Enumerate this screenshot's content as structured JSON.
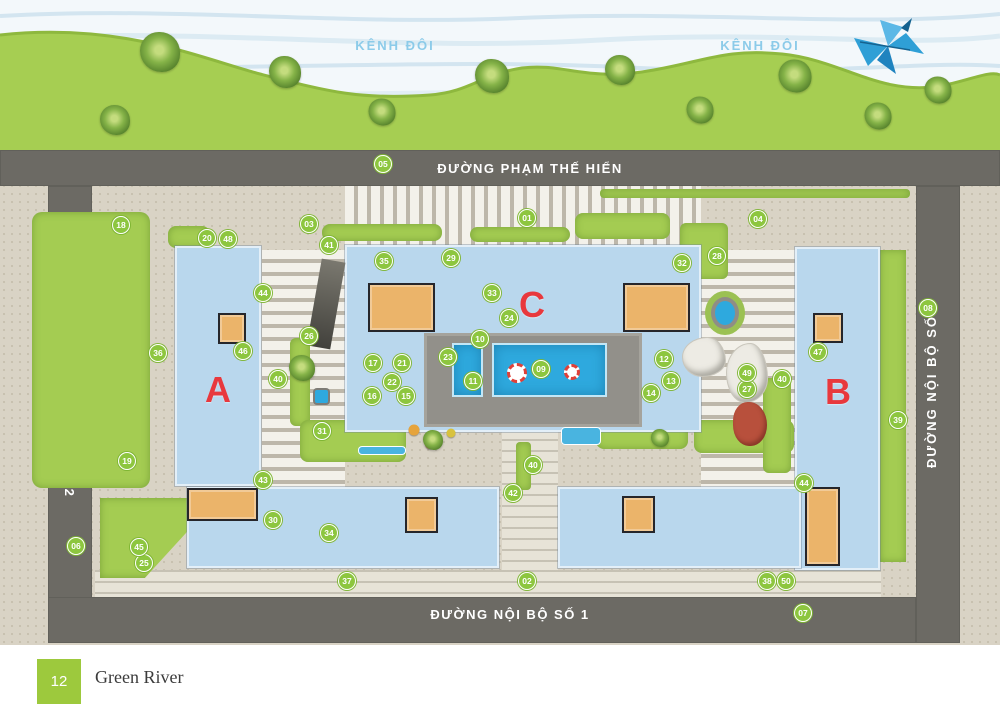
{
  "river": {
    "labels": [
      "KÊNH ĐÔI",
      "KÊNH ĐÔI"
    ],
    "label_color": "#8ccbe9"
  },
  "roads": {
    "top": {
      "label": "ĐƯỜNG PHẠM THẾ HIỂN"
    },
    "bottom": {
      "label": "ĐƯỜNG NỘI BỘ SỐ 1"
    },
    "left": {
      "label": "ĐƯỜNG NỘI BỘ SỐ 2"
    },
    "right": {
      "label": "ĐƯỜNG NỘI BỘ SỐ 3"
    }
  },
  "blocks": [
    {
      "label": "A",
      "x": 218,
      "y": 390
    },
    {
      "label": "C",
      "x": 532,
      "y": 305
    },
    {
      "label": "B",
      "x": 838,
      "y": 392
    }
  ],
  "markers": [
    {
      "n": "01",
      "x": 527,
      "y": 218
    },
    {
      "n": "02",
      "x": 527,
      "y": 581
    },
    {
      "n": "03",
      "x": 309,
      "y": 224
    },
    {
      "n": "04",
      "x": 758,
      "y": 219
    },
    {
      "n": "05",
      "x": 383,
      "y": 164
    },
    {
      "n": "06",
      "x": 76,
      "y": 546
    },
    {
      "n": "07",
      "x": 803,
      "y": 613
    },
    {
      "n": "08",
      "x": 928,
      "y": 308
    },
    {
      "n": "09",
      "x": 541,
      "y": 369
    },
    {
      "n": "10",
      "x": 480,
      "y": 339
    },
    {
      "n": "11",
      "x": 473,
      "y": 381
    },
    {
      "n": "12",
      "x": 664,
      "y": 359
    },
    {
      "n": "13",
      "x": 671,
      "y": 381
    },
    {
      "n": "14",
      "x": 651,
      "y": 393
    },
    {
      "n": "15",
      "x": 406,
      "y": 396
    },
    {
      "n": "16",
      "x": 372,
      "y": 396
    },
    {
      "n": "17",
      "x": 373,
      "y": 363
    },
    {
      "n": "18",
      "x": 121,
      "y": 225
    },
    {
      "n": "19",
      "x": 127,
      "y": 461
    },
    {
      "n": "20",
      "x": 207,
      "y": 238
    },
    {
      "n": "21",
      "x": 402,
      "y": 363
    },
    {
      "n": "22",
      "x": 392,
      "y": 382
    },
    {
      "n": "23",
      "x": 448,
      "y": 357
    },
    {
      "n": "24",
      "x": 509,
      "y": 318
    },
    {
      "n": "25",
      "x": 144,
      "y": 563
    },
    {
      "n": "26",
      "x": 309,
      "y": 336
    },
    {
      "n": "27",
      "x": 747,
      "y": 389
    },
    {
      "n": "28",
      "x": 717,
      "y": 256
    },
    {
      "n": "29",
      "x": 451,
      "y": 258
    },
    {
      "n": "30",
      "x": 273,
      "y": 520
    },
    {
      "n": "31",
      "x": 322,
      "y": 431
    },
    {
      "n": "32",
      "x": 682,
      "y": 263
    },
    {
      "n": "33",
      "x": 492,
      "y": 293
    },
    {
      "n": "34",
      "x": 329,
      "y": 533
    },
    {
      "n": "35",
      "x": 384,
      "y": 261
    },
    {
      "n": "36",
      "x": 158,
      "y": 353
    },
    {
      "n": "37",
      "x": 347,
      "y": 581
    },
    {
      "n": "38",
      "x": 767,
      "y": 581
    },
    {
      "n": "39",
      "x": 898,
      "y": 420
    },
    {
      "n": "40",
      "x": 278,
      "y": 379
    },
    {
      "n": "40",
      "x": 533,
      "y": 465
    },
    {
      "n": "40",
      "x": 782,
      "y": 379
    },
    {
      "n": "41",
      "x": 329,
      "y": 245
    },
    {
      "n": "42",
      "x": 513,
      "y": 493
    },
    {
      "n": "43",
      "x": 263,
      "y": 480
    },
    {
      "n": "44",
      "x": 263,
      "y": 293
    },
    {
      "n": "44",
      "x": 804,
      "y": 483
    },
    {
      "n": "45",
      "x": 139,
      "y": 547
    },
    {
      "n": "46",
      "x": 243,
      "y": 351
    },
    {
      "n": "47",
      "x": 818,
      "y": 352
    },
    {
      "n": "48",
      "x": 228,
      "y": 239
    },
    {
      "n": "49",
      "x": 747,
      "y": 373
    },
    {
      "n": "50",
      "x": 786,
      "y": 581
    }
  ],
  "slabs": [
    {
      "id": "A",
      "x": 175,
      "y": 246,
      "w": 86,
      "h": 240
    },
    {
      "id": "C",
      "x": 345,
      "y": 245,
      "w": 356,
      "h": 187
    },
    {
      "id": "B",
      "x": 795,
      "y": 247,
      "w": 85,
      "h": 323
    },
    {
      "id": "south-west",
      "x": 187,
      "y": 487,
      "w": 312,
      "h": 81
    },
    {
      "id": "south-east",
      "x": 558,
      "y": 487,
      "w": 243,
      "h": 81
    }
  ],
  "orange_buildings": [
    {
      "id": "c-west",
      "x": 368,
      "y": 283,
      "w": 67,
      "h": 49
    },
    {
      "id": "c-east",
      "x": 623,
      "y": 283,
      "w": 67,
      "h": 49
    },
    {
      "id": "a-annex",
      "x": 218,
      "y": 313,
      "w": 28,
      "h": 31
    },
    {
      "id": "b-annex",
      "x": 813,
      "y": 313,
      "w": 30,
      "h": 30
    },
    {
      "id": "sw-corner",
      "x": 187,
      "y": 488,
      "w": 71,
      "h": 33
    },
    {
      "id": "south-west-mid",
      "x": 405,
      "y": 497,
      "w": 33,
      "h": 36
    },
    {
      "id": "south-east-mid",
      "x": 622,
      "y": 496,
      "w": 33,
      "h": 37
    },
    {
      "id": "b-south",
      "x": 805,
      "y": 487,
      "w": 35,
      "h": 79
    }
  ],
  "green_areas": [
    {
      "id": "west-lawn",
      "x": 32,
      "y": 212,
      "w": 118,
      "h": 276,
      "r": 10
    },
    {
      "id": "south-west-lawn",
      "x": 100,
      "y": 498,
      "w": 118,
      "h": 80,
      "clip": "polygon(0 0,100% 0,38% 100%,0 100%)"
    },
    {
      "id": "east-strip",
      "x": 880,
      "y": 250,
      "w": 26,
      "h": 312
    },
    {
      "id": "north-hedge",
      "x": 600,
      "y": 189,
      "w": 310,
      "h": 9,
      "r": 4
    },
    {
      "id": "hedge-1",
      "x": 322,
      "y": 224,
      "w": 120,
      "h": 17,
      "r": 8
    },
    {
      "id": "hedge-2",
      "x": 470,
      "y": 227,
      "w": 100,
      "h": 15,
      "r": 8
    },
    {
      "id": "hedge-3",
      "x": 575,
      "y": 213,
      "w": 95,
      "h": 26,
      "r": 8
    },
    {
      "id": "ne-garden",
      "x": 680,
      "y": 223,
      "w": 48,
      "h": 56,
      "r": 6
    },
    {
      "id": "nw-garden",
      "x": 168,
      "y": 226,
      "w": 42,
      "h": 22,
      "r": 8
    },
    {
      "id": "court-west",
      "x": 290,
      "y": 338,
      "w": 20,
      "h": 88,
      "r": 6
    },
    {
      "id": "playground-lawn",
      "x": 300,
      "y": 420,
      "w": 106,
      "h": 42,
      "r": 8
    },
    {
      "id": "court-mid",
      "x": 516,
      "y": 442,
      "w": 15,
      "h": 48,
      "r": 4
    },
    {
      "id": "court-east-1",
      "x": 596,
      "y": 423,
      "w": 92,
      "h": 26,
      "r": 8
    },
    {
      "id": "court-east-2",
      "x": 694,
      "y": 420,
      "w": 100,
      "h": 33,
      "r": 8
    },
    {
      "id": "b-west-strip",
      "x": 763,
      "y": 378,
      "w": 28,
      "h": 95,
      "r": 6
    }
  ],
  "striped_areas": [
    {
      "id": "dropoff-north",
      "x": 345,
      "y": 186,
      "w": 356,
      "h": 59,
      "kind": "v"
    },
    {
      "id": "parking-west",
      "x": 262,
      "y": 250,
      "w": 83,
      "h": 238,
      "kind": "h"
    },
    {
      "id": "parking-east",
      "x": 701,
      "y": 250,
      "w": 94,
      "h": 238,
      "kind": "h"
    },
    {
      "id": "central-walk",
      "x": 502,
      "y": 428,
      "w": 56,
      "h": 169,
      "kind": "walk"
    },
    {
      "id": "south-sidewalk",
      "x": 95,
      "y": 570,
      "w": 786,
      "h": 27,
      "kind": "walk"
    }
  ],
  "features": [
    {
      "type": "deck",
      "x": 424,
      "y": 333,
      "w": 218,
      "h": 94
    },
    {
      "type": "pool",
      "x": 452,
      "y": 343,
      "w": 31,
      "h": 54
    },
    {
      "type": "pool",
      "x": 492,
      "y": 343,
      "w": 115,
      "h": 54
    },
    {
      "type": "buoy",
      "x": 517,
      "y": 373,
      "s": 20
    },
    {
      "type": "buoy",
      "x": 572,
      "y": 372,
      "s": 16
    },
    {
      "type": "spa-round",
      "x": 711,
      "y": 297,
      "w": 28,
      "h": 32
    },
    {
      "type": "spa-small",
      "x": 313,
      "y": 388,
      "w": 17,
      "h": 17
    },
    {
      "type": "water-strip",
      "x": 358,
      "y": 446,
      "w": 48,
      "h": 9
    },
    {
      "type": "water-strip",
      "x": 561,
      "y": 427,
      "w": 40,
      "h": 18
    },
    {
      "type": "mound",
      "x": 683,
      "y": 338,
      "w": 42,
      "h": 38
    },
    {
      "type": "mound",
      "x": 727,
      "y": 344,
      "w": 40,
      "h": 58
    },
    {
      "type": "play-structure",
      "x": 733,
      "y": 402,
      "w": 34,
      "h": 44
    },
    {
      "type": "ramp",
      "x": 314,
      "y": 260,
      "w": 24,
      "h": 88,
      "rot": 10
    },
    {
      "type": "dot",
      "x": 414,
      "y": 430,
      "s": 11,
      "c": "#e6a43c"
    },
    {
      "type": "dot",
      "x": 430,
      "y": 444,
      "s": 10,
      "c": "#cf5340"
    },
    {
      "type": "dot",
      "x": 451,
      "y": 433,
      "s": 9,
      "c": "#d8c23e"
    }
  ],
  "trees": [
    {
      "x": 115,
      "y": 120,
      "s": 30
    },
    {
      "x": 160,
      "y": 52,
      "s": 40
    },
    {
      "x": 285,
      "y": 72,
      "s": 32
    },
    {
      "x": 382,
      "y": 112,
      "s": 27
    },
    {
      "x": 492,
      "y": 76,
      "s": 34
    },
    {
      "x": 620,
      "y": 70,
      "s": 30
    },
    {
      "x": 700,
      "y": 110,
      "s": 27
    },
    {
      "x": 795,
      "y": 76,
      "s": 33
    },
    {
      "x": 878,
      "y": 116,
      "s": 27
    },
    {
      "x": 938,
      "y": 90,
      "s": 27
    },
    {
      "x": 302,
      "y": 368,
      "s": 26
    },
    {
      "x": 433,
      "y": 440,
      "s": 20
    },
    {
      "x": 660,
      "y": 438,
      "s": 18
    }
  ],
  "footer": {
    "page": "12",
    "project": "Green River"
  },
  "colors": {
    "marker_green": "#8dc63f",
    "block_letter_red": "#e8383d",
    "pool_blue": "#2ea9de",
    "slab_blue": "#b9d7ed",
    "building_orange": "#ebb46a",
    "road_gray": "#6c6a64",
    "bank_green": "#a6ce52",
    "footer_green": "#9dc93d"
  }
}
